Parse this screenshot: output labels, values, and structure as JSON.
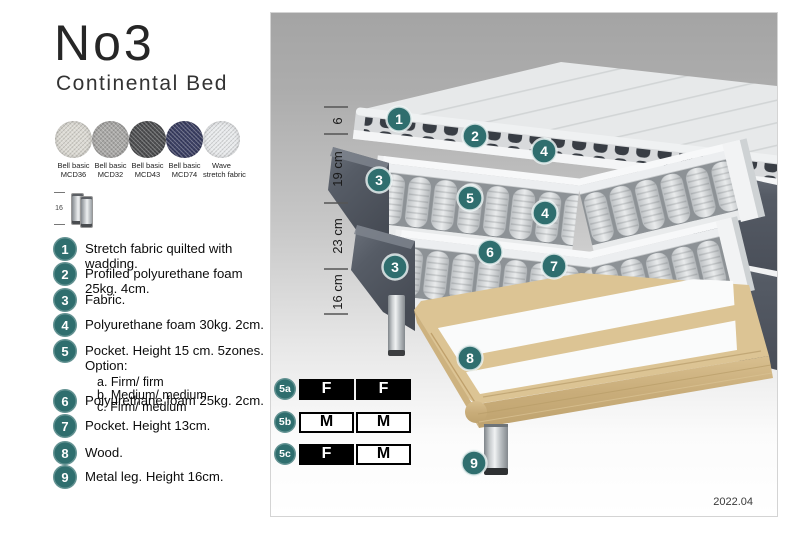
{
  "title": "No3",
  "subtitle": "Continental Bed",
  "swatches": [
    {
      "line1": "Bell basic",
      "line2": "MCD36",
      "color": "#dcdad3"
    },
    {
      "line1": "Bell basic",
      "line2": "MCD32",
      "color": "#a9a8a6"
    },
    {
      "line1": "Bell basic",
      "line2": "MCD43",
      "color": "#4e4f51"
    },
    {
      "line1": "Bell basic",
      "line2": "MCD74",
      "color": "#3b3f63"
    },
    {
      "line1": "Wave",
      "line2": "stretch fabric",
      "color": "#e8eaec"
    }
  ],
  "leg_sample": {
    "height_label": "16"
  },
  "legend": {
    "items": [
      {
        "num": "1",
        "text": "Stretch fabric quilted with wadding."
      },
      {
        "num": "2",
        "text": "Profiled polyurethane foam 25kg. 4cm."
      },
      {
        "num": "3",
        "text": "Fabric."
      },
      {
        "num": "4",
        "text": "Polyurethane foam 30kg. 2cm."
      },
      {
        "num": "5",
        "text": "Pocket. Height 15 cm. 5zones. Option:",
        "options": [
          "a. Firm/ firm",
          "b. Medium/ medium",
          "c. Firm/ medium"
        ]
      },
      {
        "num": "6",
        "text": "Polyurethane foam 25kg. 2cm."
      },
      {
        "num": "7",
        "text": "Pocket. Height 13cm."
      },
      {
        "num": "8",
        "text": "Wood."
      },
      {
        "num": "9",
        "text": "Metal leg. Height 16cm."
      }
    ]
  },
  "diagram": {
    "dimensions": [
      "6",
      "19 cm",
      "23 cm",
      "16 cm"
    ],
    "callouts": [
      "1",
      "2",
      "4",
      "3",
      "5",
      "4",
      "6",
      "3",
      "7",
      "8",
      "9"
    ],
    "firmness_options": [
      {
        "id": "5a",
        "cells": [
          {
            "label": "F",
            "filled": true
          },
          {
            "label": "F",
            "filled": true
          }
        ]
      },
      {
        "id": "5b",
        "cells": [
          {
            "label": "M",
            "filled": false
          },
          {
            "label": "M",
            "filled": false
          }
        ]
      },
      {
        "id": "5c",
        "cells": [
          {
            "label": "F",
            "filled": true
          },
          {
            "label": "M",
            "filled": false
          }
        ]
      }
    ],
    "version": "2022.04"
  },
  "colors": {
    "accent_teal": "#2f6e6e",
    "dark_fabric": "#4f545c",
    "wood": "#dcc494",
    "option_black": "#000000",
    "panel_gray_top": "#a4a4a4"
  }
}
